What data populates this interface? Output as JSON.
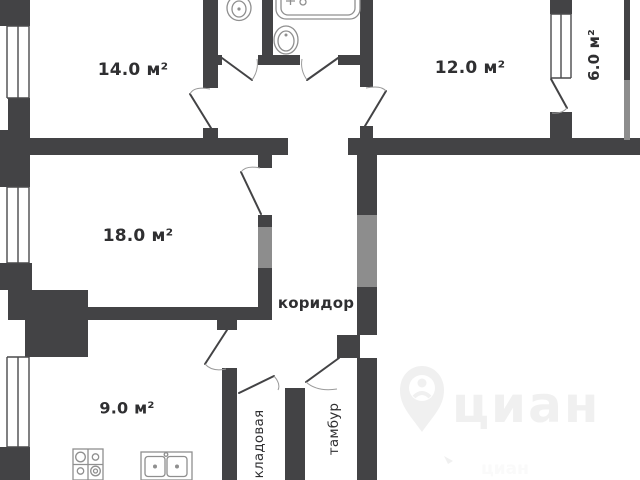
{
  "plan": {
    "type": "apartment-floor-plan",
    "rooms": [
      {
        "id": "room-14",
        "label": "14.0 м²"
      },
      {
        "id": "room-12",
        "label": "12.0 м²"
      },
      {
        "id": "balcony",
        "label": "6.0 м²"
      },
      {
        "id": "room-18",
        "label": "18.0 м²"
      },
      {
        "id": "kitchen",
        "label": "9.0 м²"
      },
      {
        "id": "corridor",
        "label": "коридор"
      },
      {
        "id": "storage",
        "label": "кладовая"
      },
      {
        "id": "vestibule",
        "label": "тамбур"
      }
    ],
    "fixtures": [
      "toilet",
      "bathtub",
      "washbasin",
      "stove",
      "double-sink"
    ],
    "watermark": {
      "text": "циан",
      "small_text": "циан"
    }
  },
  "colors": {
    "background": "#ffffff",
    "wall": "#434345",
    "wall_light": "#8d8d8d",
    "line": "#4a4a4c",
    "fixture": "#8f8f8f",
    "label": "#2f2f31",
    "watermark": "#f0f0f0"
  }
}
